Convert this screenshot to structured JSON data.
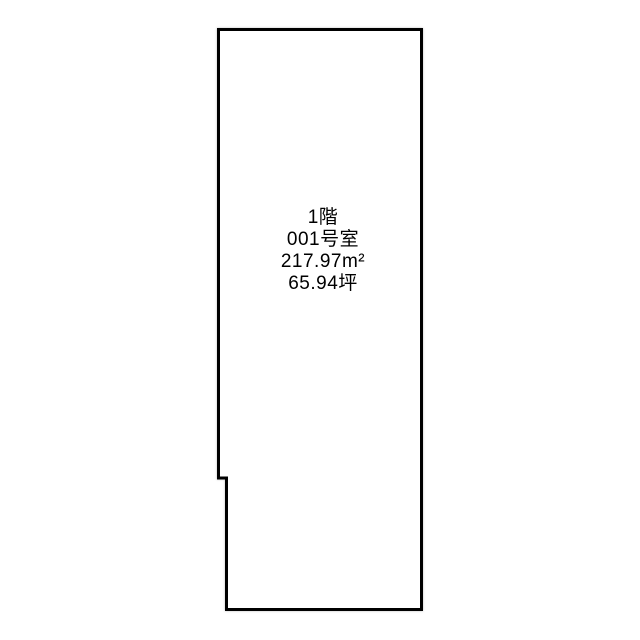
{
  "floorplan": {
    "unit": {
      "floor_label": "1階",
      "room_label": "001号室",
      "area_sqm_label": "217.97m²",
      "area_tsubo_label": "65.94坪"
    },
    "colors": {
      "outline": "#000000",
      "background": "#ffffff"
    }
  }
}
